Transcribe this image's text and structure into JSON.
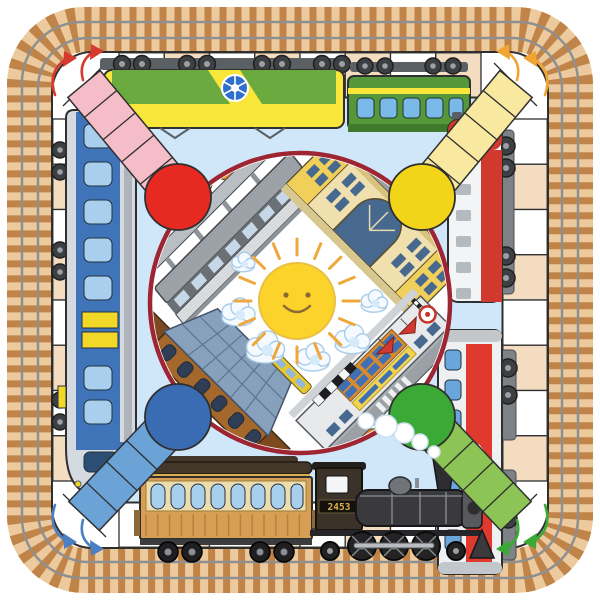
{
  "board": {
    "kind": "train-themed ludo game mat",
    "margin_background": "#ffffff",
    "field_color": "#cfe7f8",
    "ring": {
      "cell_light": "#ffffff",
      "cell_dark": "#f3dcc0",
      "outline": "#2f2f2f",
      "cells_per_side": 8
    },
    "track_border": {
      "base": "#ecca9e",
      "tie": "#c08448",
      "rail": "#8f8f8f"
    },
    "center_circle": {
      "fill": "#ffffff",
      "rim_color": "#9e2633"
    }
  },
  "players": [
    {
      "id": "red",
      "corner": "top-left",
      "path_color": "#f5bdc8",
      "circle_color": "#e62a22",
      "arrow_color": "#d63a2f"
    },
    {
      "id": "yellow",
      "corner": "top-right",
      "path_color": "#f8e8a0",
      "circle_color": "#f2d418",
      "arrow_color": "#f0a432"
    },
    {
      "id": "blue",
      "corner": "bottom-left",
      "path_color": "#6ba3d6",
      "circle_color": "#3a6cb4",
      "arrow_color": "#4a7fc1"
    },
    {
      "id": "green",
      "corner": "bottom-right",
      "path_color": "#8cc455",
      "circle_color": "#3aa935",
      "arrow_color": "#3aa935"
    }
  ],
  "center": {
    "sun": {
      "body": "#fbd32a",
      "rays": "#efa83c",
      "face": "#8a6a35",
      "expression": "smiling"
    },
    "clouds_color": "#f4faff",
    "stations": [
      {
        "position": "top-left",
        "style": "modern terminal with autumn trees"
      },
      {
        "position": "top-right",
        "style": "classical yellow facade, arched window, cars and bus"
      },
      {
        "position": "bottom-left",
        "style": "twin-tower station with glass train shed and tram"
      },
      {
        "position": "bottom-right",
        "style": "modern station with sign, umbrellas and level crossing"
      }
    ]
  },
  "trains": {
    "top_locomotive": {
      "kind": "electric locomotive",
      "body": "#6aaa3f",
      "accent": "#f9e63b",
      "logo_color": "#2f6fd0"
    },
    "top_coach": {
      "kind": "passenger coach",
      "body": "#57973b",
      "stripe": "#f9e63b",
      "window": "#79b9e8"
    },
    "right_locomotive_upper": {
      "kind": "diesel locomotive",
      "body": "#f2f4f5",
      "accent": "#d2392e"
    },
    "right_locomotive_lower": {
      "kind": "electric locomotive",
      "body": "#eef0f2",
      "band": "#e03a2f",
      "window": "#6aa6dc"
    },
    "left_train": {
      "kind": "suburban passenger train",
      "hull": "#d5dae0",
      "band": "#3f74b8",
      "window": "#a9cfee",
      "door": "#f2d929"
    },
    "bottom_coach": {
      "kind": "vintage wooden coach",
      "body": "#d79e54",
      "roof": "#43372a",
      "window": "#a9cfee"
    },
    "steam_locomotive": {
      "kind": "steam locomotive",
      "number": "2453",
      "body": "#3a3a3c",
      "steam": "#ffffff"
    }
  }
}
